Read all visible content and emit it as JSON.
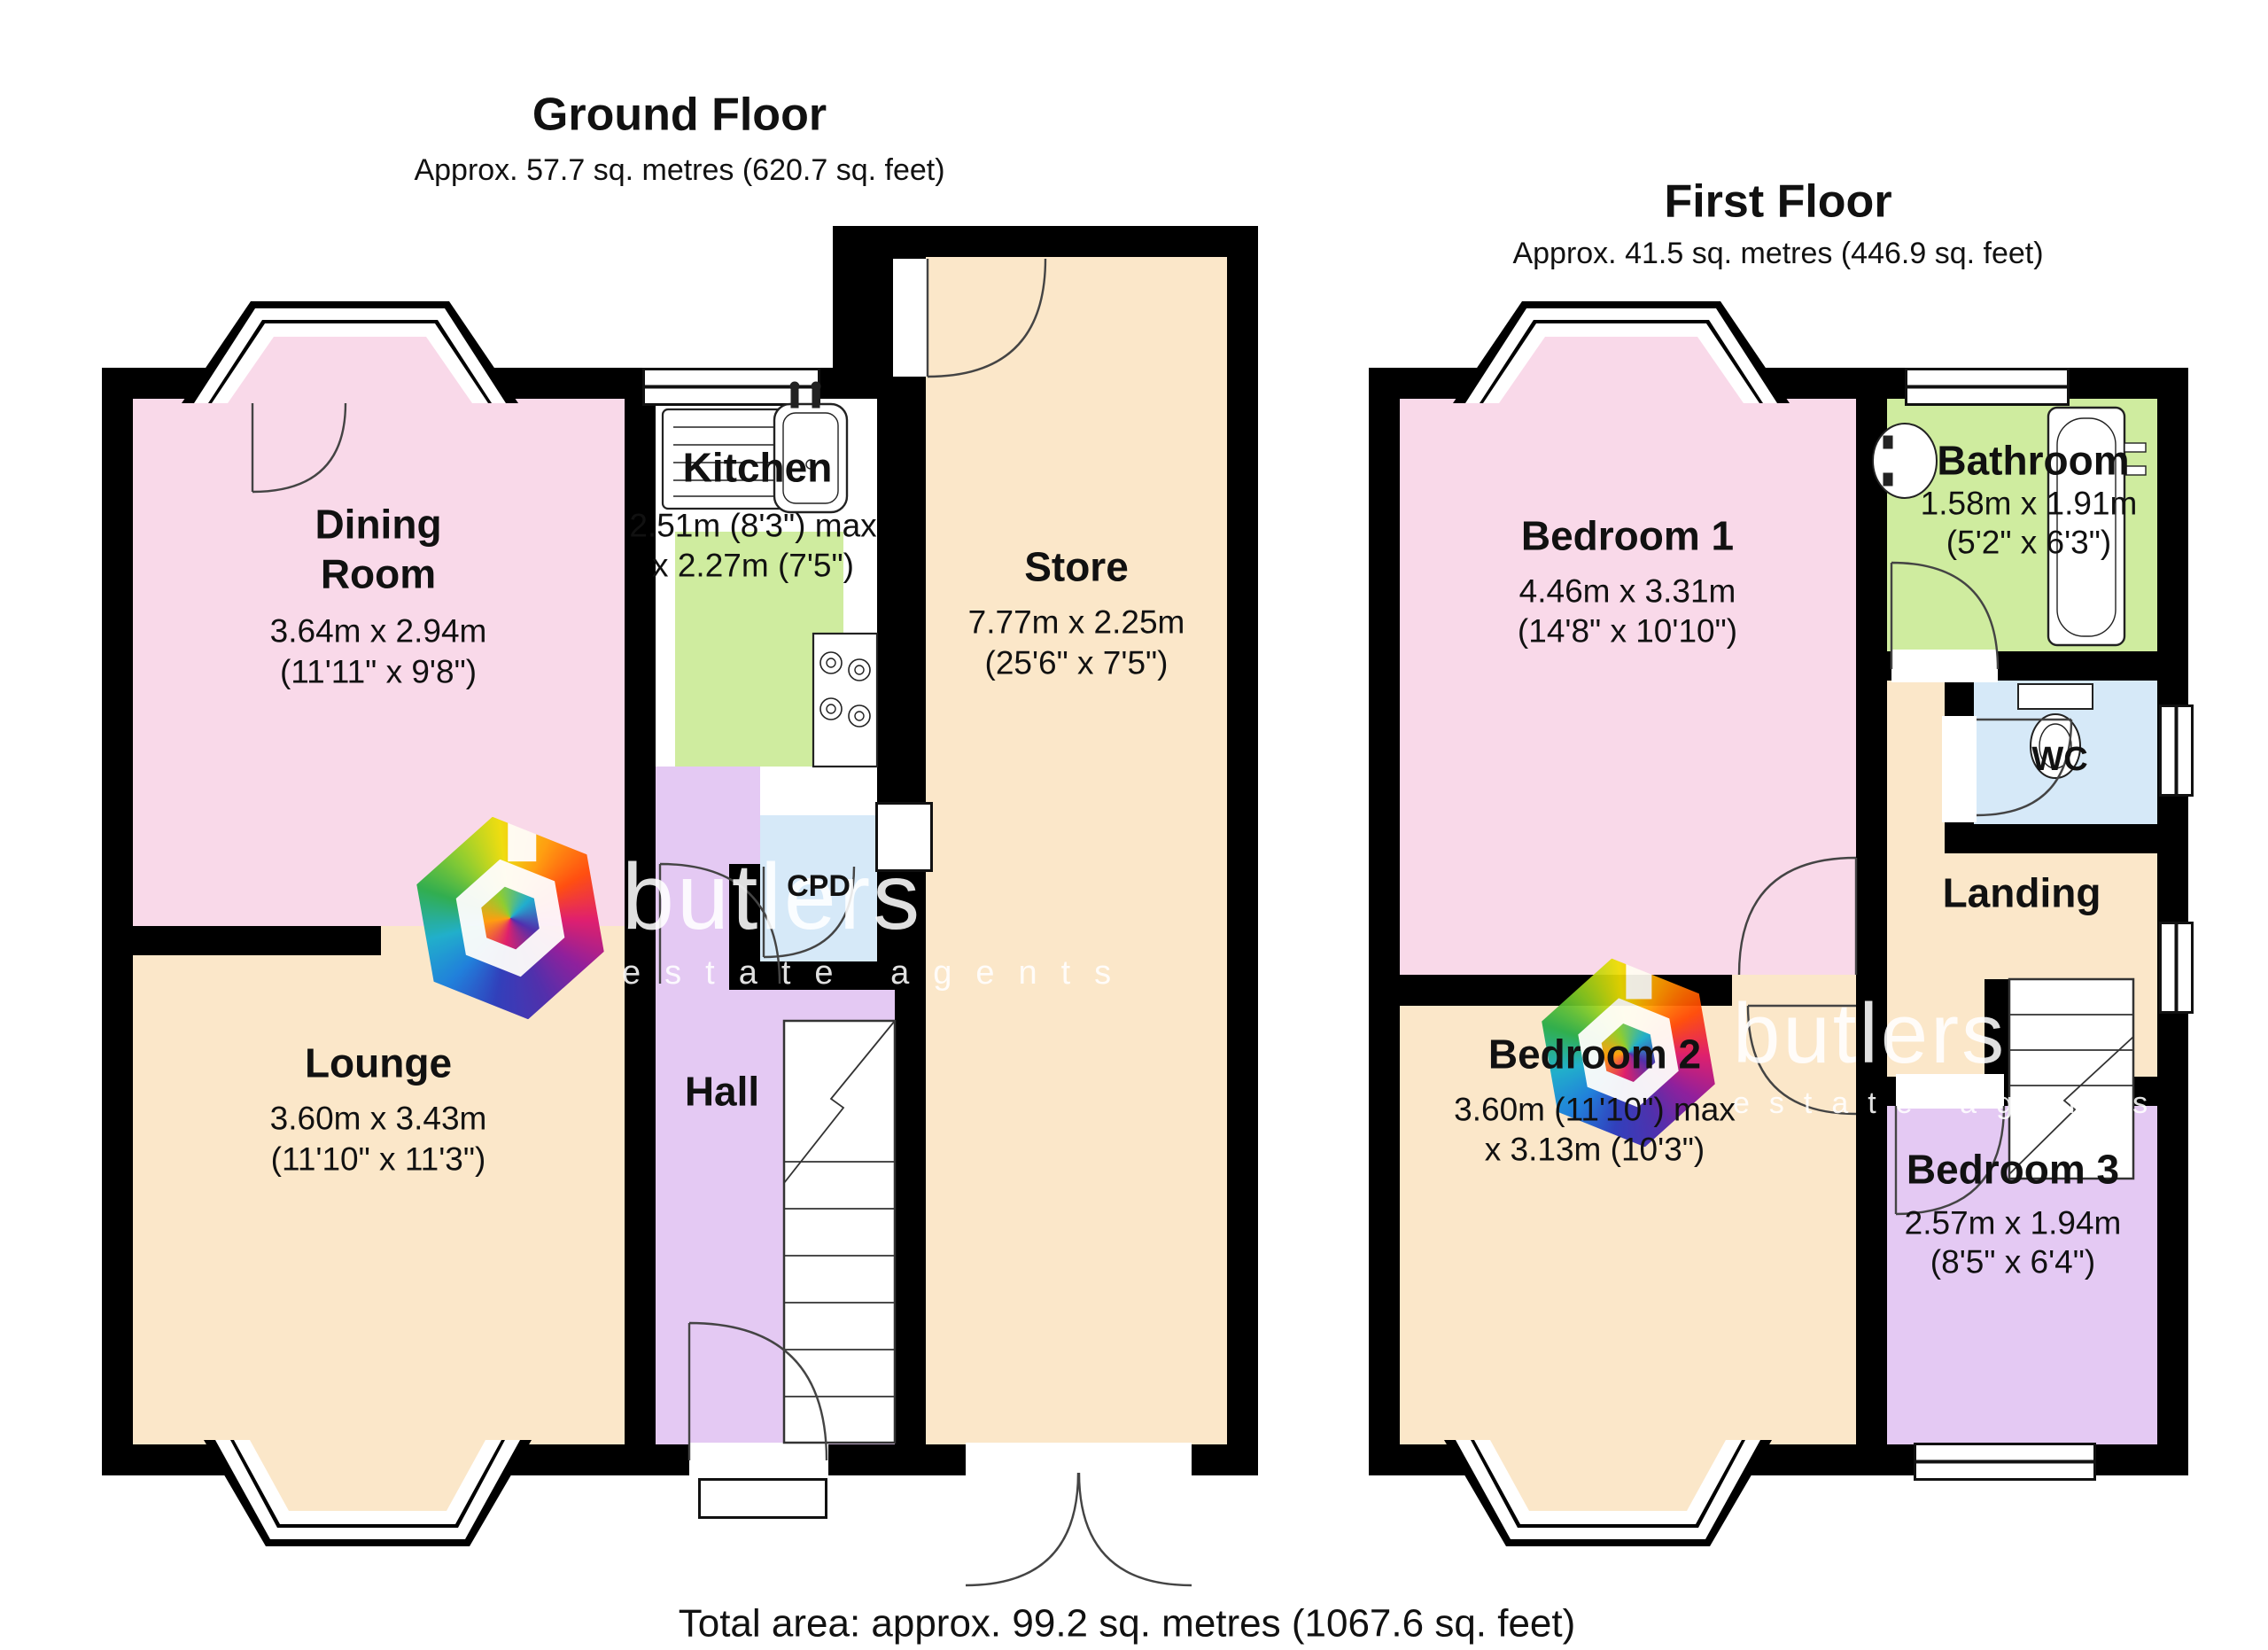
{
  "header": {
    "ground_title": "Ground Floor",
    "ground_area": "Approx. 57.7 sq. metres (620.7 sq. feet)",
    "first_title": "First Floor",
    "first_area": "Approx. 41.5 sq. metres (446.9 sq. feet)",
    "total": "Total area: approx. 99.2 sq. metres (1067.6 sq. feet)"
  },
  "rooms": {
    "dining": {
      "name_line1": "Dining",
      "name_line2": "Room",
      "dim_m": "3.64m x 2.94m",
      "dim_ft": "(11'11\" x 9'8\")"
    },
    "kitchen": {
      "name": "Kitchen",
      "dim1": "2.51m (8'3\") max",
      "dim2": "x 2.27m (7'5\")"
    },
    "store": {
      "name": "Store",
      "dim_m": "7.77m x 2.25m",
      "dim_ft": "(25'6\" x 7'5\")"
    },
    "lounge": {
      "name": "Lounge",
      "dim_m": "3.60m x 3.43m",
      "dim_ft": "(11'10\" x 11'3\")"
    },
    "hall": {
      "name": "Hall"
    },
    "cpd": {
      "name": "CPD"
    },
    "bedroom1": {
      "name": "Bedroom 1",
      "dim_m": "4.46m x 3.31m",
      "dim_ft": "(14'8\" x 10'10\")"
    },
    "bathroom": {
      "name": "Bathroom",
      "dim_m": "1.58m x 1.91m",
      "dim_ft": "(5'2\" x 6'3\")"
    },
    "wc": {
      "name": "WC"
    },
    "landing": {
      "name": "Landing"
    },
    "bedroom2": {
      "name": "Bedroom 2",
      "dim1": "3.60m (11'10\") max",
      "dim2": "x 3.13m (10'3\")"
    },
    "bedroom3": {
      "name": "Bedroom 3",
      "dim_m": "2.57m x 1.94m",
      "dim_ft": "(8'5\" x 6'4\")"
    }
  },
  "watermark": {
    "brand": "butlers",
    "tagline": "estate agents"
  },
  "colors": {
    "wall": "#000000",
    "room_pink": "#f9d9e9",
    "room_cream": "#fbe7c9",
    "room_green": "#cfec9f",
    "room_purple": "#e4c9f3",
    "room_blue": "#d6e9f8",
    "background": "#ffffff"
  }
}
